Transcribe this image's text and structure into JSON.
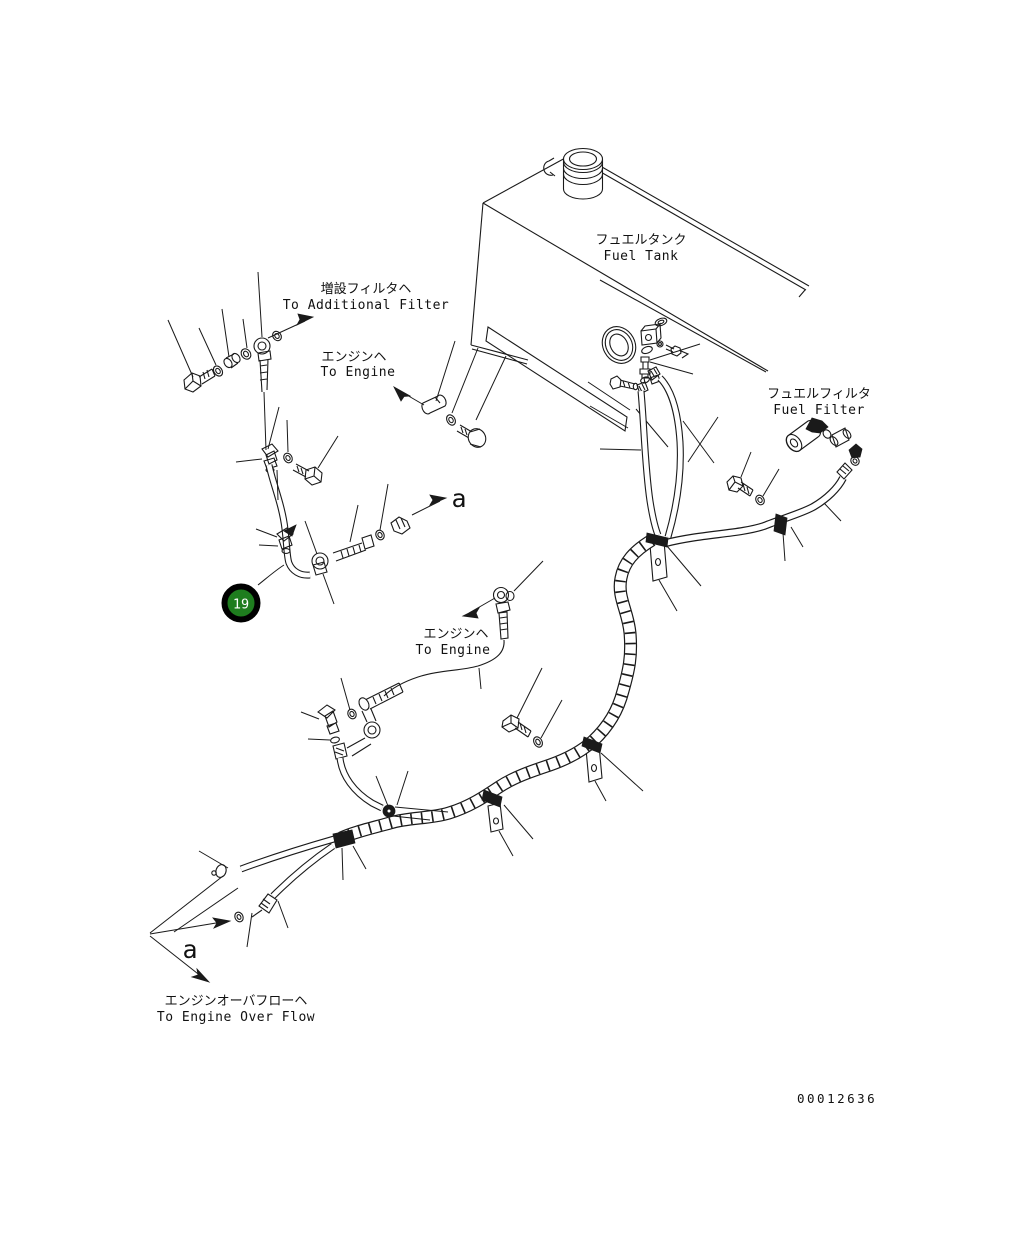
{
  "labels": {
    "to_additional_filter": {
      "jp": "増設フィルタヘ",
      "en": "To Additional Filter"
    },
    "to_engine_1": {
      "jp": "エンジンヘ",
      "en": "To Engine"
    },
    "fuel_tank": {
      "jp": "フュエルタンク",
      "en": "Fuel Tank"
    },
    "fuel_filter": {
      "jp": "フュエルフィルタ",
      "en": "Fuel Filter"
    },
    "to_engine_2": {
      "jp": "エンジンヘ",
      "en": "To Engine"
    },
    "to_engine_overflow": {
      "jp": "エンジンオーバフローヘ",
      "en": "To Engine Over Flow"
    },
    "view_arrow_a_upper": "a",
    "view_arrow_a_lower": "a",
    "drawing_number": "00012636"
  },
  "balloon": {
    "number": "19"
  },
  "colors": {
    "line": "#1a1a1a",
    "balloon_fill": "#1e7d1e",
    "balloon_ring": "#000000",
    "balloon_text": "#ffffff",
    "background": "#ffffff"
  }
}
